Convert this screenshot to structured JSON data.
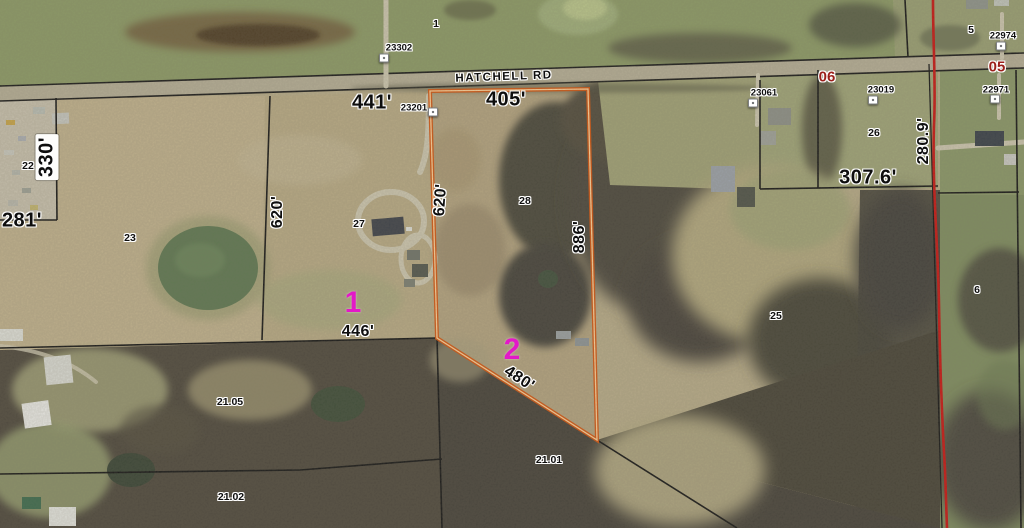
{
  "map": {
    "road": {
      "label": "HATCHELL RD"
    },
    "subject_parcel": {
      "numbers": [
        "1",
        "2"
      ],
      "frontage": "405'",
      "side_west": "620'",
      "side_east": "886'",
      "rear": "480'"
    },
    "labels": [
      {
        "type": "road",
        "text": "HATCHELL RD",
        "x": 504,
        "y": 77,
        "rot": -2
      },
      {
        "type": "section",
        "text": "06",
        "x": 827,
        "y": 77
      },
      {
        "type": "section",
        "text": "05",
        "x": 997,
        "y": 67
      },
      {
        "type": "measure-lg",
        "text": "441'",
        "x": 372,
        "y": 103
      },
      {
        "type": "measure-lg",
        "text": "405'",
        "x": 506,
        "y": 100
      },
      {
        "type": "measure-lg",
        "text": "330'",
        "x": 47,
        "y": 157,
        "rot": -90,
        "capsule": true
      },
      {
        "type": "measure-lg",
        "text": "281'",
        "x": 22,
        "y": 221
      },
      {
        "type": "measure",
        "text": "620'",
        "x": 278,
        "y": 212,
        "rot": -90
      },
      {
        "type": "measure",
        "text": "620'",
        "x": 441,
        "y": 200,
        "rot": -86
      },
      {
        "type": "measure",
        "text": "886'",
        "x": 580,
        "y": 237,
        "rot": -90
      },
      {
        "type": "measure",
        "text": "446'",
        "x": 358,
        "y": 332
      },
      {
        "type": "measure",
        "text": "480'",
        "x": 519,
        "y": 379,
        "rot": 33
      },
      {
        "type": "measure-lg",
        "text": "307.6'",
        "x": 868,
        "y": 178
      },
      {
        "type": "measure",
        "text": "280.9'",
        "x": 924,
        "y": 141,
        "rot": -90
      },
      {
        "type": "parcel-id",
        "text": "23302",
        "x": 399,
        "y": 48
      },
      {
        "type": "parcel-id",
        "text": "23201",
        "x": 414,
        "y": 108
      },
      {
        "type": "parcel-id",
        "text": "23061",
        "x": 764,
        "y": 93
      },
      {
        "type": "parcel-id",
        "text": "23019",
        "x": 881,
        "y": 90
      },
      {
        "type": "parcel-id",
        "text": "22974",
        "x": 1003,
        "y": 36
      },
      {
        "type": "parcel-id",
        "text": "22971",
        "x": 996,
        "y": 90
      },
      {
        "type": "lot",
        "text": "1",
        "x": 436,
        "y": 24
      },
      {
        "type": "lot",
        "text": "5",
        "x": 971,
        "y": 30
      },
      {
        "type": "lot",
        "text": "22",
        "x": 28,
        "y": 166
      },
      {
        "type": "lot",
        "text": "23",
        "x": 130,
        "y": 238
      },
      {
        "type": "lot",
        "text": "27",
        "x": 359,
        "y": 224
      },
      {
        "type": "lot",
        "text": "28",
        "x": 525,
        "y": 201
      },
      {
        "type": "lot",
        "text": "26",
        "x": 874,
        "y": 133
      },
      {
        "type": "lot",
        "text": "25",
        "x": 776,
        "y": 316
      },
      {
        "type": "lot",
        "text": "6",
        "x": 977,
        "y": 290
      },
      {
        "type": "lot",
        "text": "21.05",
        "x": 230,
        "y": 402
      },
      {
        "type": "lot",
        "text": "21.02",
        "x": 231,
        "y": 497
      },
      {
        "type": "lot",
        "text": "21.01",
        "x": 549,
        "y": 460
      },
      {
        "type": "highlight",
        "text": "1",
        "x": 353,
        "y": 303
      },
      {
        "type": "highlight",
        "text": "2",
        "x": 512,
        "y": 350
      }
    ],
    "markers": [
      {
        "x": 384,
        "y": 58
      },
      {
        "x": 433,
        "y": 112
      },
      {
        "x": 753,
        "y": 103
      },
      {
        "x": 873,
        "y": 100
      },
      {
        "x": 1001,
        "y": 46
      },
      {
        "x": 995,
        "y": 99
      }
    ],
    "colors": {
      "subject_outline": "#d4540f",
      "subject_outline_core": "#ffcf96",
      "section_line_red": "#c81512",
      "section_text_red": "#9b1f1a",
      "highlight_magenta": "#e318c8",
      "boundary_black": "#161616",
      "road_surface": "#b5ae96"
    }
  }
}
